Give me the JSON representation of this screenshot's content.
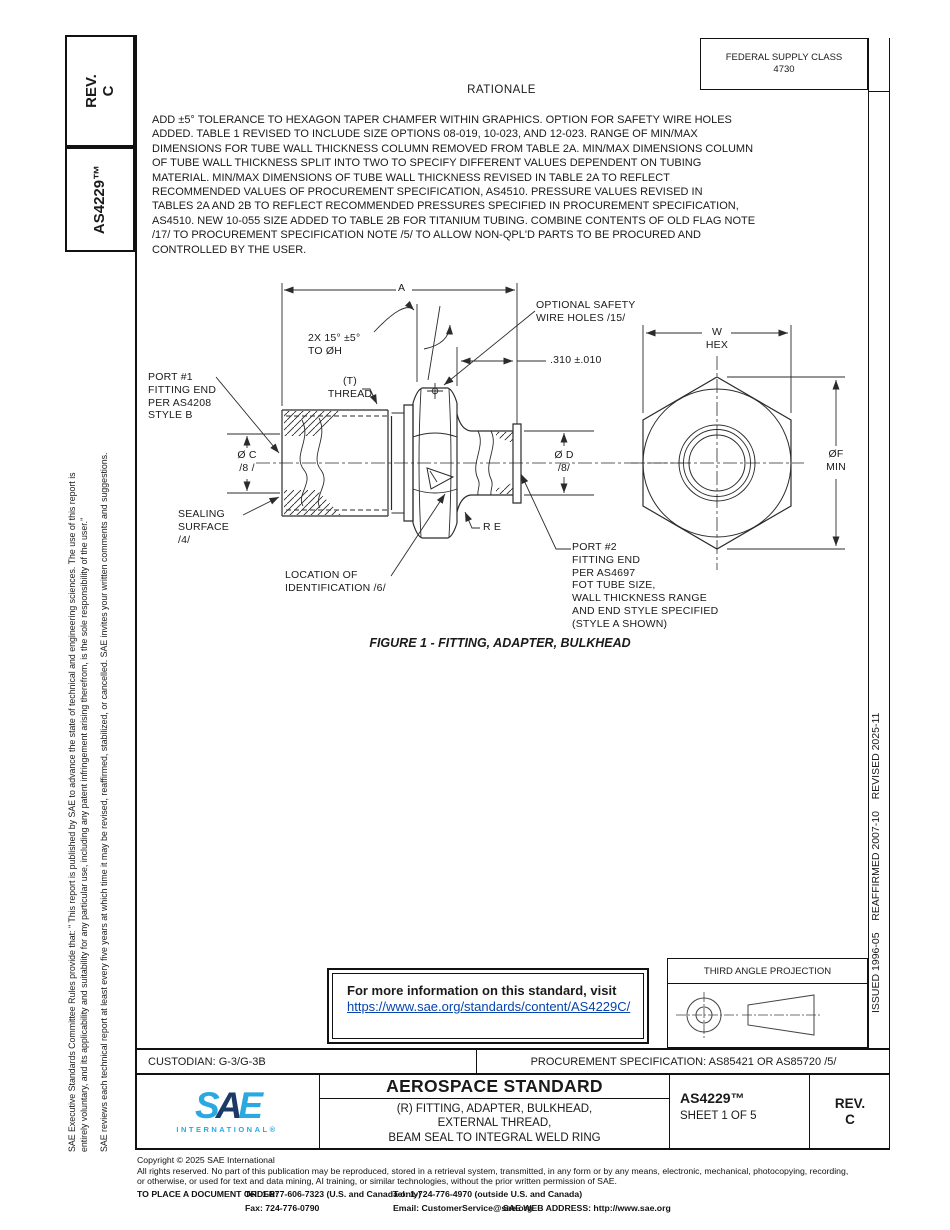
{
  "colors": {
    "link_blue": "#0645ad",
    "logo_light_blue": "#2aa9e0",
    "logo_dark_blue": "#1b3a66",
    "line_black": "#111111"
  },
  "sidebar_left": {
    "rev": "REV.\nC",
    "doc_number": "AS4229™",
    "disclaimer_p1": "SAE Executive Standards Committee Rules provide that: \" This report is published by SAE to advance the state of technical and engineering sciences. The use of this report is\nentirely voluntary, and its applicability and suitability for any particular use, including any patent infringement arising therefrom, is the sole responsibility of the user.\"",
    "disclaimer_p2": "SAE reviews each technical report at least every five years at which time it may be revised, reaffirmed, stabilized, or cancelled. SAE invites your written comments and suggestions."
  },
  "sidebar_right": {
    "history": "ISSUED 1996-05    REAFFIRMED 2007-10    REVISED 2025-11"
  },
  "header": {
    "federal_supply_class": "FEDERAL SUPPLY CLASS\n4730"
  },
  "rationale": {
    "title": "RATIONALE",
    "body": "ADD ±5° TOLERANCE TO HEXAGON TAPER CHAMFER WITHIN GRAPHICS. OPTION FOR SAFETY WIRE HOLES\nADDED. TABLE 1 REVISED TO INCLUDE SIZE OPTIONS 08-019, 10-023, AND 12-023. RANGE OF MIN/MAX\nDIMENSIONS FOR TUBE WALL THICKNESS COLUMN REMOVED FROM TABLE 2A. MIN/MAX DIMENSIONS COLUMN\nOF TUBE WALL THICKNESS SPLIT INTO TWO TO SPECIFY DIFFERENT VALUES DEPENDENT ON TUBING\nMATERIAL. MIN/MAX DIMENSIONS OF TUBE WALL THICKNESS REVISED IN TABLE 2A TO REFLECT\nRECOMMENDED VALUES OF PROCUREMENT SPECIFICATION, AS4510. PRESSURE VALUES REVISED IN\nTABLES 2A AND 2B TO REFLECT RECOMMENDED PRESSURES SPECIFIED IN PROCUREMENT SPECIFICATION,\nAS4510. NEW 10-055 SIZE ADDED TO TABLE 2B FOR TITANIUM TUBING. COMBINE CONTENTS OF OLD FLAG NOTE\n/17/ TO PROCUREMENT SPECIFICATION NOTE /5/ TO ALLOW NON-QPL'D PARTS TO BE PROCURED AND\nCONTROLLED BY THE USER."
  },
  "drawing": {
    "caption": "FIGURE 1 - FITTING, ADAPTER, BULKHEAD",
    "labels": {
      "dim_a": "A",
      "chamfer": "2X 15° ±5°\nTO ØH",
      "safety_wire": "OPTIONAL SAFETY\nWIRE HOLES /15/",
      "offset_310": ".310 ±.010",
      "port1": "PORT #1\nFITTING END\nPER AS4208\nSTYLE B",
      "thread": "(T)\nTHREAD",
      "dia_c": "Ø C\n/8 /",
      "dia_d": "Ø D\n/8/",
      "sealing": "SEALING\nSURFACE\n/4/",
      "radius_e": "R E",
      "location_id": "LOCATION OF\nIDENTIFICATION /6/",
      "port2": "PORT #2\nFITTING END\nPER AS4697\nFOT TUBE SIZE,\nWALL THICKNESS RANGE\nAND END STYLE SPECIFIED\n(STYLE A SHOWN)",
      "w_hex": "W\nHEX",
      "dia_f": "ØF\nMIN"
    }
  },
  "info_box": {
    "intro": "For more information on this standard, visit",
    "link": "https://www.sae.org/standards/content/AS4229C/"
  },
  "projection": {
    "label": "THIRD ANGLE PROJECTION"
  },
  "custodian_bar": {
    "custodian": "CUSTODIAN: G-3/G-3B",
    "procurement": "PROCUREMENT SPECIFICATION: AS85421 OR AS85720 /5/"
  },
  "title_block": {
    "logo_s": "S",
    "logo_a": "A",
    "logo_e": "E",
    "logo_sub": "INTERNATIONAL®",
    "kind": "AEROSPACE STANDARD",
    "subject": "(R) FITTING, ADAPTER, BULKHEAD,\nEXTERNAL THREAD,\nBEAM SEAL TO INTEGRAL WELD RING",
    "number": "AS4229™",
    "sheet": "SHEET 1 OF 5",
    "rev": "REV.\nC"
  },
  "footer": {
    "copyright": "Copyright © 2025 SAE International",
    "rights": "All rights reserved. No part of this publication may be reproduced, stored in a retrieval system, transmitted, in any form or by any means, electronic, mechanical, photocopying, recording,\nor otherwise, or used for text and data mining, AI training, or similar technologies, without the prior written permission of SAE.",
    "order_label": "TO PLACE A DOCUMENT ORDER:",
    "tel1": "Tel: 1-877-606-7323 (U.S. and Canada only)",
    "tel2": "Tel: 1-724-776-4970 (outside U.S. and Canada)",
    "fax": "Fax: 724-776-0790",
    "email": "Email: CustomerService@sae.org",
    "web": "SAE WEB ADDRESS: http://www.sae.org"
  }
}
